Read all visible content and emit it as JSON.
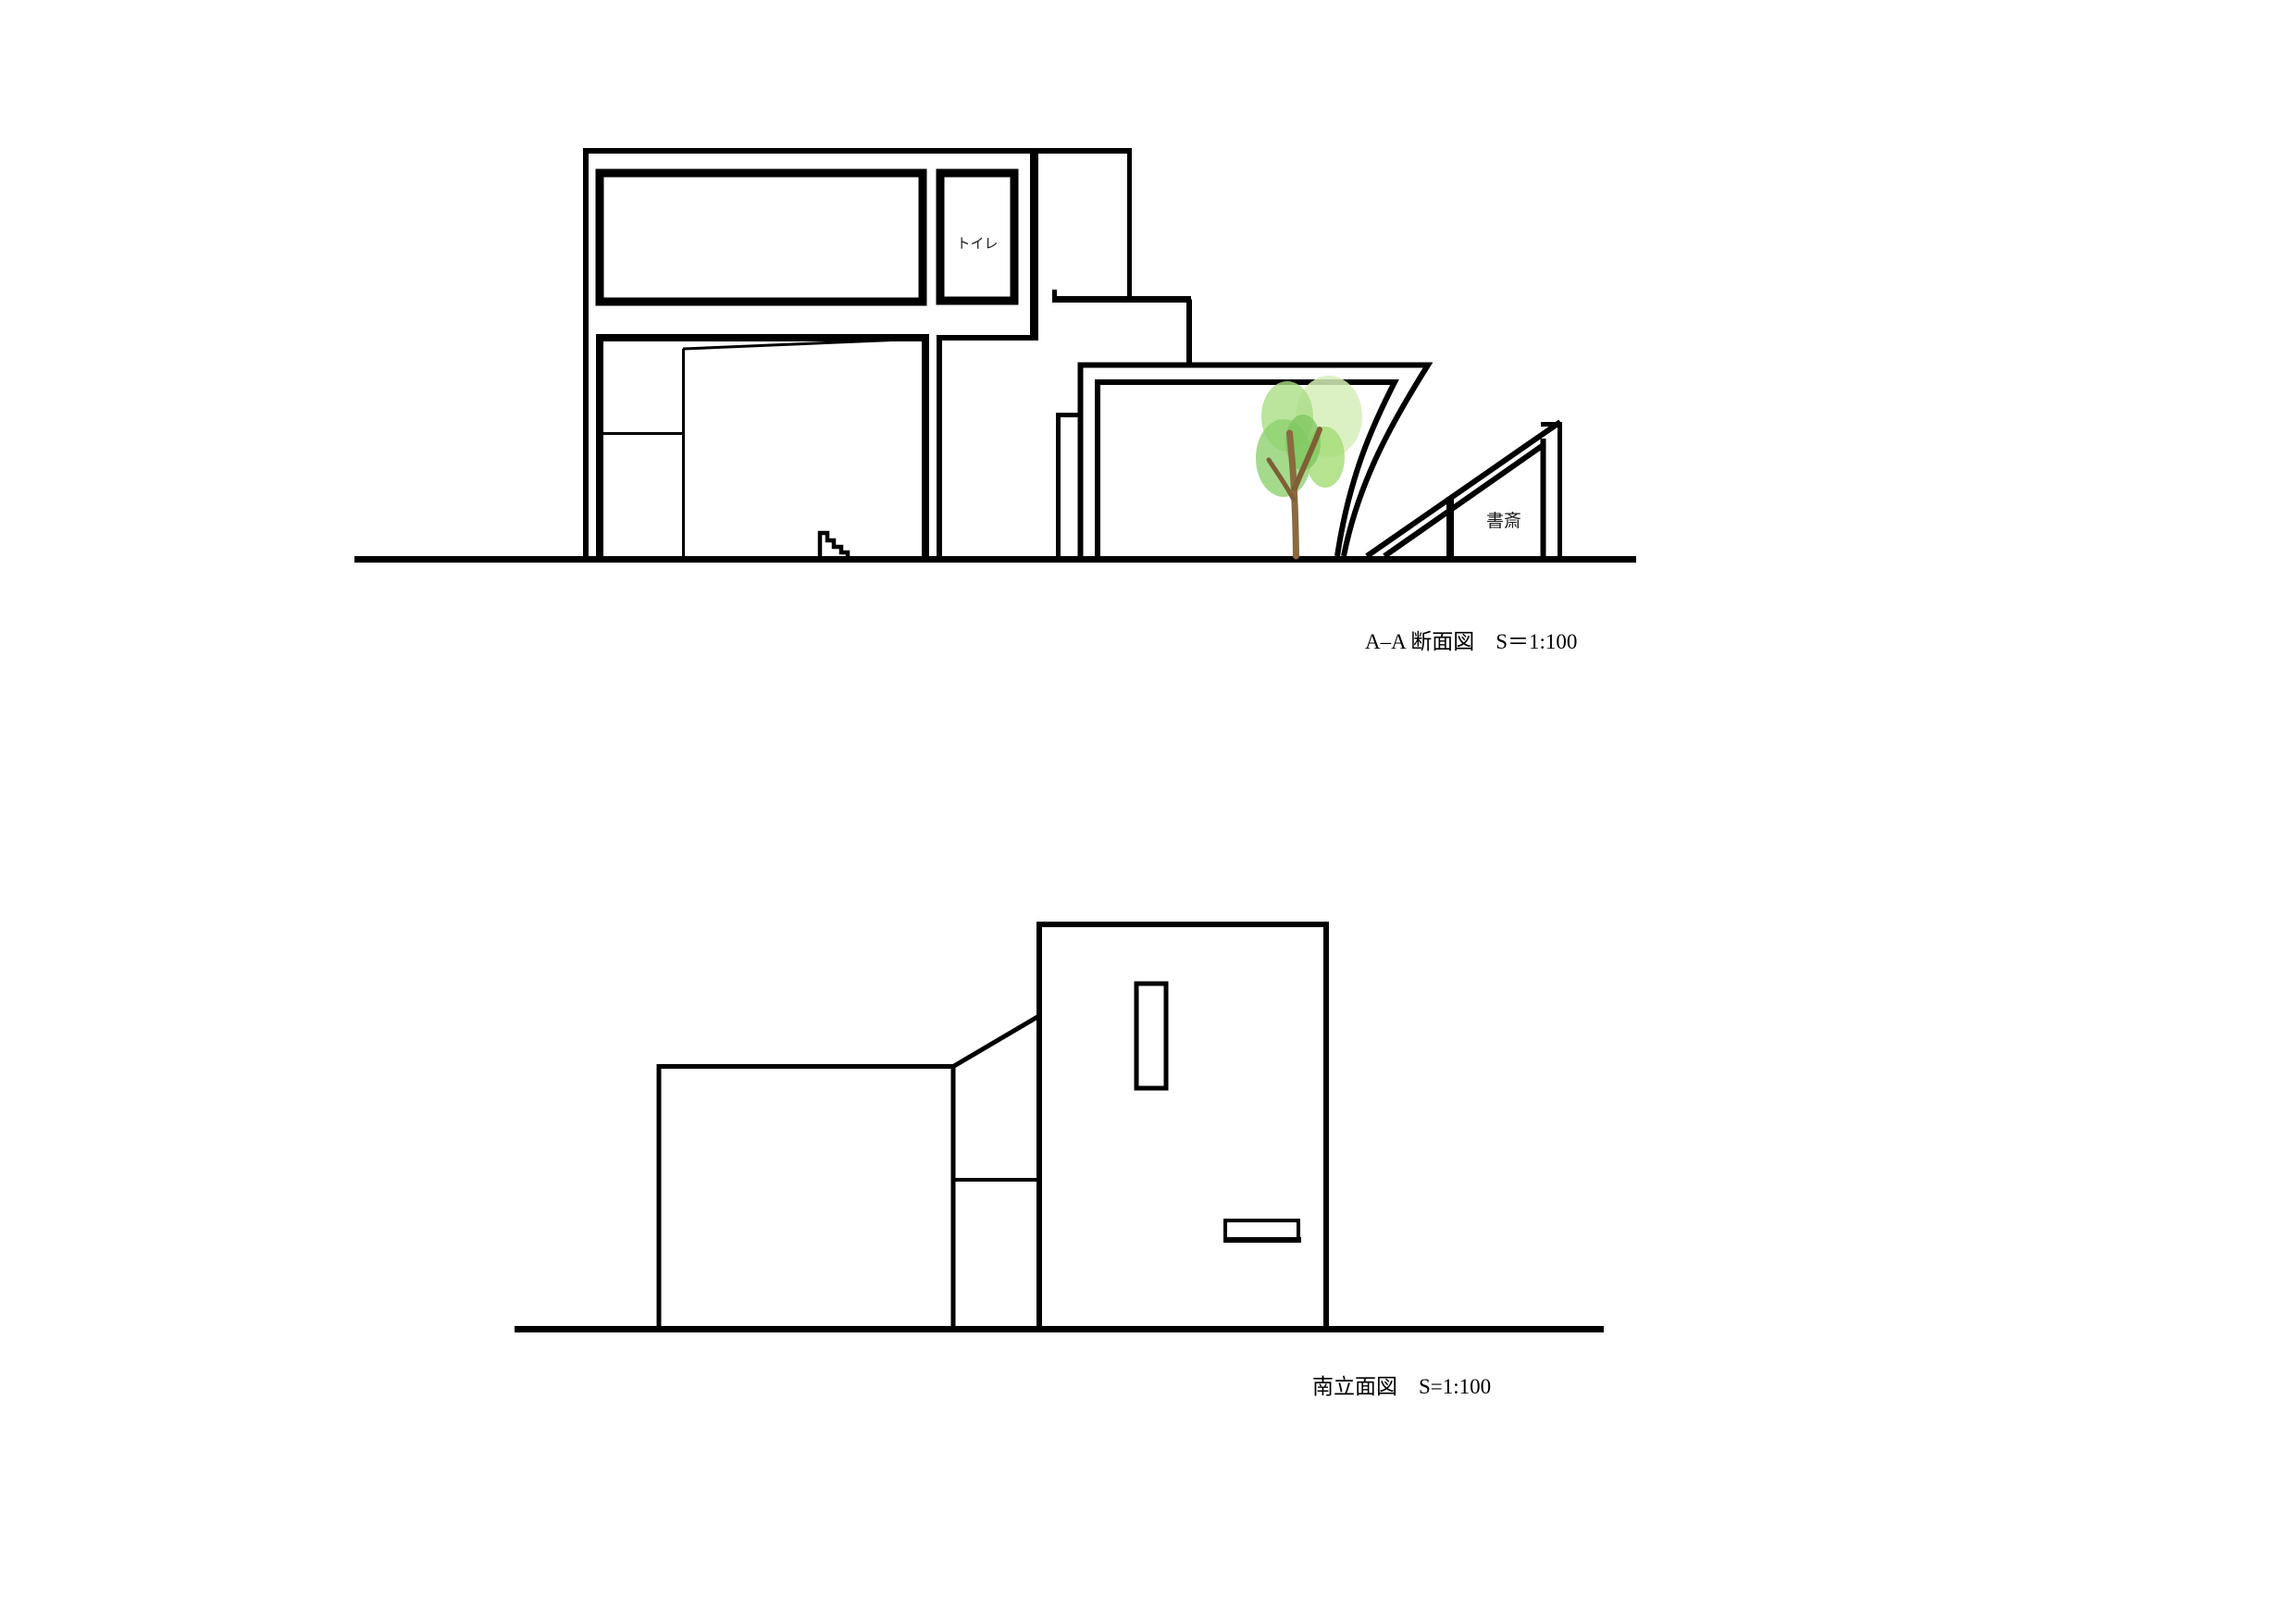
{
  "section_view": {
    "caption": "A–A 断面図　S＝1:100",
    "labels": {
      "toilet": "トイレ",
      "study": "書斎"
    }
  },
  "elevation_view": {
    "caption": "南立面図　S=1:100"
  },
  "colors": {
    "line": "#000000",
    "background": "#ffffff",
    "tree_trunk": "#8a6a3f",
    "tree_branch": "#7e5f36",
    "foliage_pale": "#d6efb8",
    "foliage_light": "#aadd84",
    "foliage_mid": "#8ed170",
    "foliage_mid2": "#a2dc74",
    "foliage_dark": "#7cc65e"
  }
}
